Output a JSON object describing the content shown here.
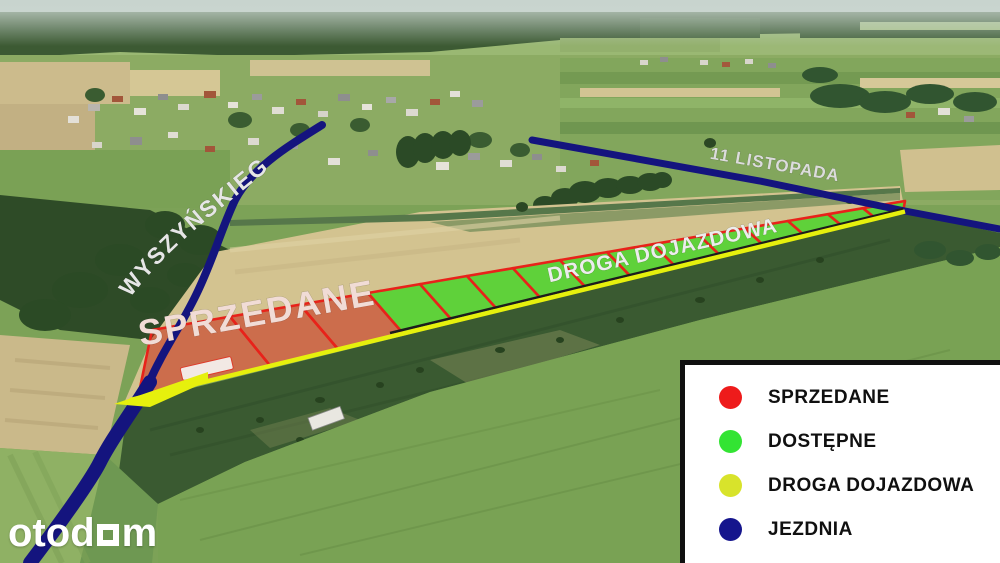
{
  "map_labels": {
    "street_left": "WYSZYŃSKIEGO",
    "street_top": "11 LISTOPADA",
    "access_road": "DROGA DOJAZDOWA",
    "sold_area": "SPRZEDANE"
  },
  "legend": {
    "items": [
      {
        "id": "sold",
        "label": "SPRZEDANE",
        "color": "#ee1b1b"
      },
      {
        "id": "available",
        "label": "DOSTĘPNE",
        "color": "#33e433"
      },
      {
        "id": "access-road",
        "label": "DROGA DOJAZDOWA",
        "color": "#d8e32b"
      },
      {
        "id": "road",
        "label": "JEZDNIA",
        "color": "#15158d"
      }
    ]
  },
  "logo": {
    "text_before_mark": "otod",
    "text_after_mark": "m"
  },
  "colors": {
    "plot_border": "#e8221a",
    "sold_fill": "rgba(198,38,20,0.55)",
    "available_fill": "#55d233",
    "access_road": "#e6f00d",
    "road": "#14147e"
  },
  "plots": {
    "strip_top": {
      "x1": 152,
      "y1": 330,
      "x2": 905,
      "y2": 201
    },
    "strip_bottom": {
      "x1": 120,
      "y1": 402,
      "x2": 903,
      "y2": 212
    },
    "boundaries": [
      {
        "tx": 152,
        "d": -14
      },
      {
        "tx": 230,
        "d": 40
      },
      {
        "tx": 300,
        "d": 38
      },
      {
        "tx": 368,
        "d": 35
      },
      {
        "tx": 420,
        "d": 33
      },
      {
        "tx": 467,
        "d": 31
      },
      {
        "tx": 513,
        "d": 29
      },
      {
        "tx": 560,
        "d": 27
      },
      {
        "tx": 607,
        "d": 25
      },
      {
        "tx": 653,
        "d": 23
      },
      {
        "tx": 700,
        "d": 21
      },
      {
        "tx": 745,
        "d": 19
      },
      {
        "tx": 788,
        "d": 17
      },
      {
        "tx": 828,
        "d": 15
      },
      {
        "tx": 863,
        "d": 13
      },
      {
        "tx": 905,
        "d": -2
      }
    ],
    "cells": [
      "sold",
      "sold",
      "sold",
      "available",
      "available",
      "available",
      "available",
      "available",
      "available",
      "available",
      "available",
      "available",
      "available",
      "available",
      "available"
    ]
  }
}
